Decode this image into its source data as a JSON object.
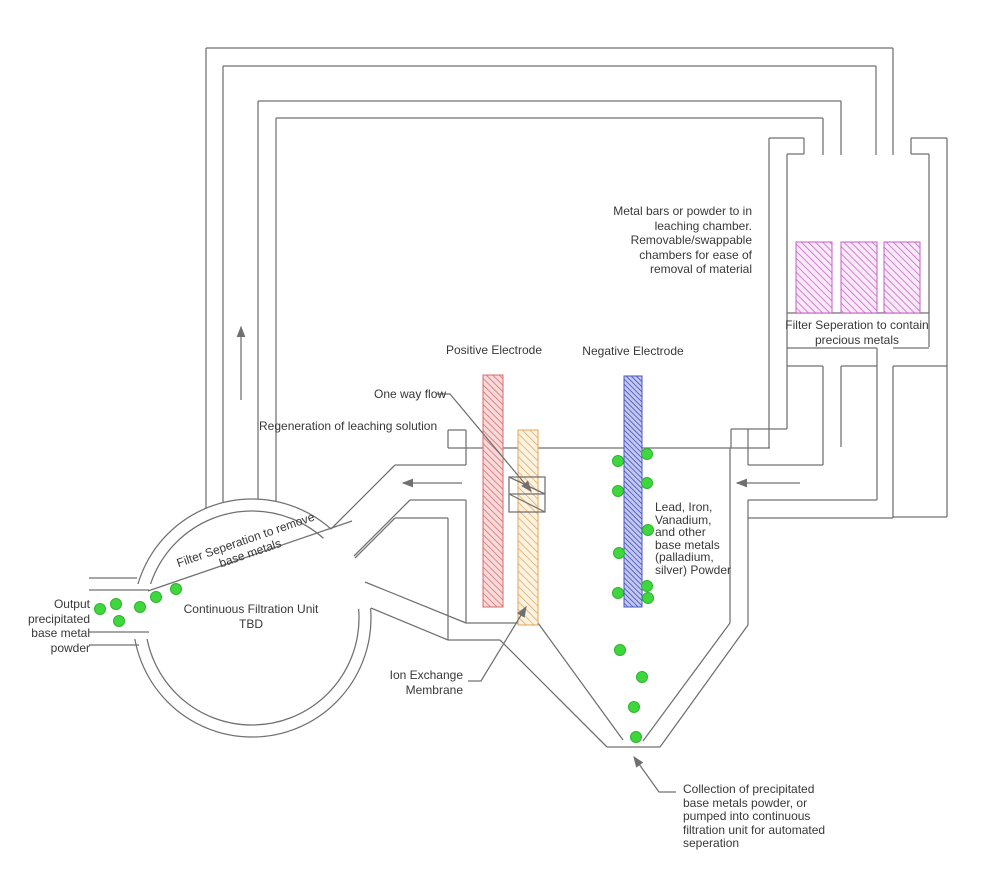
{
  "title": "Precious metal leaching and electro-filtration process diagram",
  "labels": {
    "metal_bars_note": "Metal bars or powder to in\nleaching chamber.\nRemovable/swappable\nchambers for ease of\nremoval of material",
    "filter_contain": "Filter Seperation to contain\nprecious metals",
    "positive_electrode": "Positive Electrode",
    "negative_electrode": "Negative Electrode",
    "one_way_flow": "One way flow",
    "regeneration": "Regeneration of leaching solution",
    "lead_iron": "Lead, Iron,\nVanadium,\nand other\nbase metals\n(palladium,\nsilver) Powder",
    "filter_remove": "Filter Seperation to remove\nbase metals",
    "continuous_filtration": "Continuous Filtration Unit\nTBD",
    "output_powder": "Output\nprecipitated\nbase metal\npowder",
    "ion_exchange": "Ion Exchange\nMembrane",
    "collection_note": "Collection of precipitated\nbase metals powder, or\npumped into continuous\nfiltration unit for automated\nseperation"
  },
  "colors": {
    "line": "#707070",
    "text": "#383838",
    "positive_hatch": "#d96a6a",
    "positive_tint": "#f8dada",
    "negative_hatch": "#4a56c6",
    "negative_tint": "#c3c8ee",
    "membrane_hatch": "#e2a556",
    "membrane_tint": "#fdf3e3",
    "precious_hatch": "#c65fc6",
    "precious_tint": "#f9e9f9",
    "powder": "#3ed83e",
    "powder_edge": "#2db32d"
  },
  "powder_dots": [
    [
      100,
      609
    ],
    [
      116,
      604
    ],
    [
      119,
      621
    ],
    [
      140,
      607
    ],
    [
      156,
      597
    ],
    [
      176,
      589
    ],
    [
      618,
      461
    ],
    [
      618,
      491
    ],
    [
      619,
      553
    ],
    [
      618,
      593
    ],
    [
      647,
      454
    ],
    [
      647,
      483
    ],
    [
      648,
      530
    ],
    [
      647,
      586
    ],
    [
      648,
      598
    ],
    [
      620,
      650
    ],
    [
      642,
      677
    ],
    [
      634,
      707
    ],
    [
      636,
      737
    ]
  ],
  "flow_arrows": {
    "up_arrow": "upward flow in return duct",
    "left_arrow_tank_out": "flow from tank to filtration unit",
    "left_arrow_chamber_out": "flow from leaching chamber to tank"
  }
}
